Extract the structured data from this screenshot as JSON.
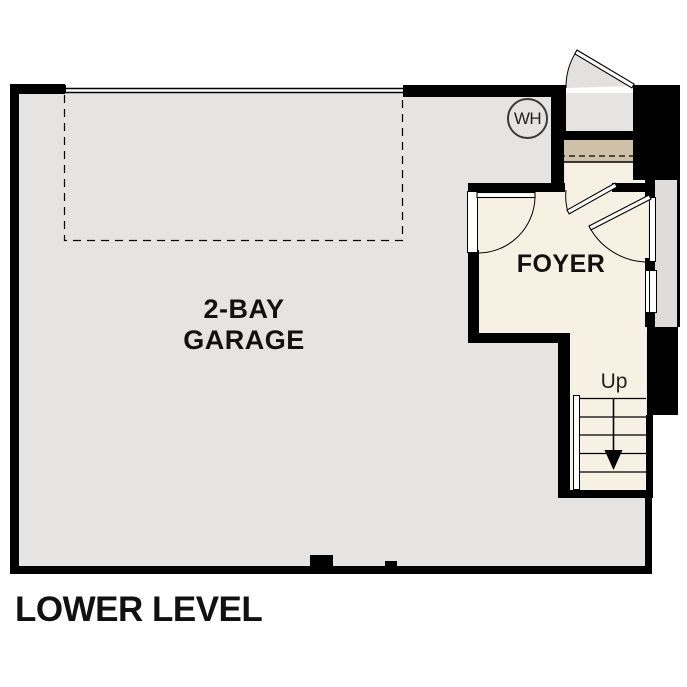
{
  "plan": {
    "title": "LOWER LEVEL",
    "rooms": {
      "garage": {
        "label": "2-BAY\nGARAGE"
      },
      "foyer": {
        "label": "FOYER"
      },
      "stairs": {
        "direction_label": "Up"
      },
      "water_heater": {
        "label": "WH"
      }
    },
    "colors": {
      "wall": "#000000",
      "garage-floor": "#e5e4e2",
      "foyer-floor": "#f7f1e4",
      "step-accent": "#cfc1a7",
      "stoop": "#dedddb",
      "ink": "#111111"
    }
  }
}
